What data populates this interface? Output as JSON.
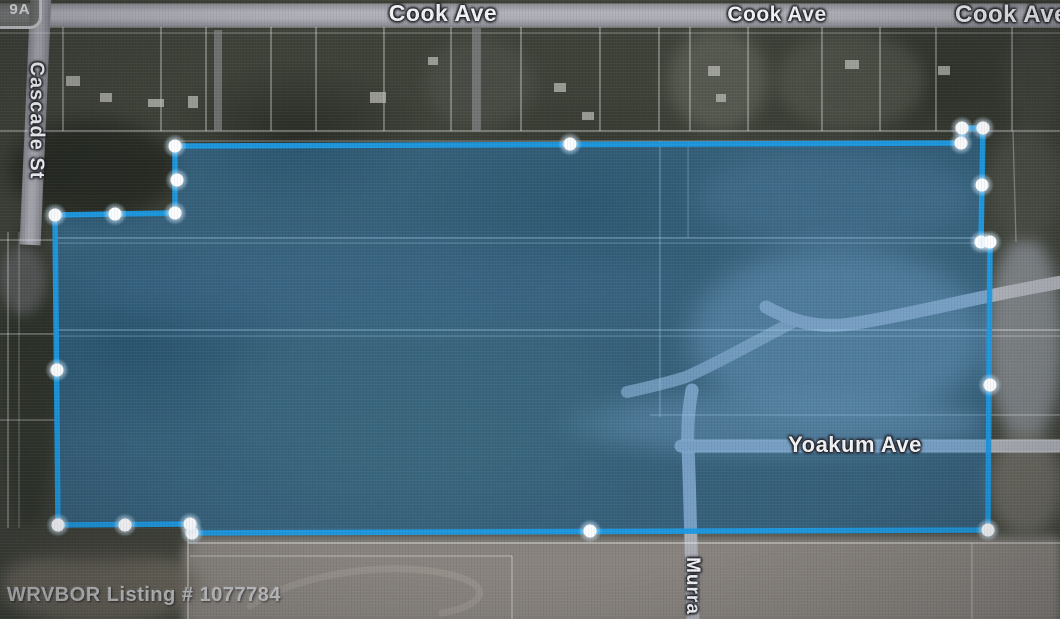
{
  "labels": {
    "cook_ave_west": "Cook Ave",
    "cook_ave_center": "Cook Ave",
    "cook_ave_east": "Cook Ave",
    "cascade_st": "Cascade St",
    "yoakum_ave": "Yoakum Ave",
    "murray_partial": "Murra",
    "route_shield": "9A"
  },
  "watermark": {
    "text": "WRVBOR Listing # 1077784"
  },
  "boundary": {
    "stroke_color": "#1b9ae4",
    "fill_color": "rgba(45,140,215,0.42)",
    "handle_color": "#ffffff",
    "vertex_handle_count": 20
  },
  "map_features": {
    "road_color": "#abadb5",
    "parcel_line_color": "#ffffff"
  }
}
